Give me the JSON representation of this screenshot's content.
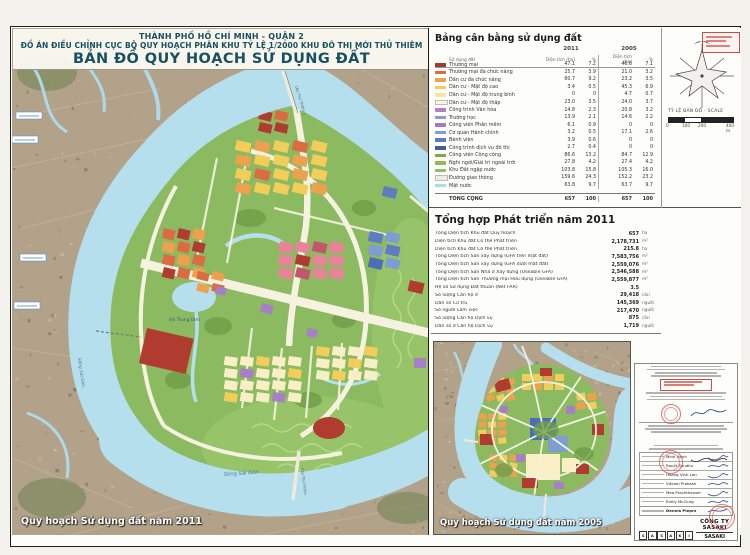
{
  "title": {
    "line1": "THÀNH PHỐ HỒ CHÍ MINH - QUẬN 2",
    "line2": "ĐỒ ÁN ĐIỀU CHỈNH CỤC BỘ QUY HOẠCH PHÂN KHU TỶ LỆ 1/2000 KHU ĐÔ THỊ MỚI THỦ THIÊM",
    "line3": "BẢN ĐỒ QUY HOẠCH SỬ DỤNG ĐẤT"
  },
  "balance_table": {
    "title": "Bảng cân bằng sử dụng đất",
    "year1": "2011",
    "year2": "2005",
    "col_land_use": "Sử dụng đất",
    "col_area": "Diện tích (ha)",
    "col_pct": "%",
    "rows": [
      {
        "name": "Thương mại",
        "color": "#a03a30",
        "a1": "47.1",
        "p1": "7.2",
        "a2": "46.6",
        "p2": "7.1"
      },
      {
        "name": "Thương mại đa chức năng",
        "color": "#dd6b42",
        "a1": "25.7",
        "p1": "3.9",
        "a2": "21.0",
        "p2": "3.2"
      },
      {
        "name": "Dân cư đa chức năng",
        "color": "#eda14f",
        "a1": "60.7",
        "p1": "9.2",
        "a2": "23.2",
        "p2": "3.5"
      },
      {
        "name": "Dân cư - Mật độ cao",
        "color": "#f2cd5a",
        "a1": "3.4",
        "p1": "0.5",
        "a2": "45.3",
        "p2": "6.9"
      },
      {
        "name": "Dân cư - Mật độ trung bình",
        "color": "#f6e59c",
        "a1": "0",
        "p1": "0",
        "a2": "4.7",
        "p2": "0.7"
      },
      {
        "name": "Dân cư - Mật độ thấp",
        "color": "#fcf6d8",
        "a1": "23.0",
        "p1": "3.5",
        "a2": "24.0",
        "p2": "3.7"
      },
      {
        "name": "Công trình Văn hóa",
        "color": "#b27fc6",
        "a1": "14.8",
        "p1": "2.3",
        "a2": "20.8",
        "p2": "3.2"
      },
      {
        "name": "Trường học",
        "color": "#9099cf",
        "a1": "13.9",
        "p1": "2.1",
        "a2": "14.6",
        "p2": "2.2"
      },
      {
        "name": "Công viên Phần mềm",
        "color": "#9f7cc5",
        "a1": "6.1",
        "p1": "0.9",
        "a2": "0",
        "p2": "0"
      },
      {
        "name": "Cơ quan Hành chính",
        "color": "#7e9ed2",
        "a1": "3.2",
        "p1": "0.5",
        "a2": "17.1",
        "p2": "2.6"
      },
      {
        "name": "Bệnh viện",
        "color": "#5d7dc0",
        "a1": "3.9",
        "p1": "0.6",
        "a2": "0",
        "p2": "0"
      },
      {
        "name": "Công trình dịch vụ đô thị",
        "color": "#3f5f9d",
        "a1": "2.7",
        "p1": "0.4",
        "a2": "0",
        "p2": "0"
      },
      {
        "name": "Công viên Công cộng",
        "color": "#77a94d",
        "a1": "86.6",
        "p1": "13.2",
        "a2": "84.7",
        "p2": "12.9"
      },
      {
        "name": "Nghỉ ngơi/Giải trí ngoài trời",
        "color": "#9fb35c",
        "a1": "27.8",
        "p1": "4.2",
        "a2": "27.4",
        "p2": "4.2"
      },
      {
        "name": "Khu Đất ngập nước",
        "color": "#8ec16d",
        "a1": "103.8",
        "p1": "15.8",
        "a2": "105.3",
        "p2": "16.0"
      },
      {
        "name": "Đường giao thông",
        "color": "#f0ecdc",
        "a1": "159.6",
        "p1": "24.3",
        "a2": "152.2",
        "p2": "23.2"
      },
      {
        "name": "Mặt nước",
        "color": "#aadcea",
        "a1": "63.8",
        "p1": "9.7",
        "a2": "63.7",
        "p2": "9.7"
      }
    ],
    "total_label": "TỔNG CỘNG",
    "total": {
      "a1": "657",
      "p1": "100",
      "a2": "657",
      "p2": "100"
    }
  },
  "development": {
    "title": "Tổng hợp Phát triển năm 2011",
    "rows": [
      {
        "label": "Tổng Diện tích Khu đất Quy hoạch",
        "value": "657",
        "unit": "ha"
      },
      {
        "label": "Diện tích Khu đất Có thể Phát triển",
        "value": "2,178,731",
        "unit": "m²"
      },
      {
        "label": "Diện tích Khu đất Có thể Phát triển",
        "value": "215.8",
        "unit": "ha"
      },
      {
        "label": "Tổng Diện tích Sàn xây dựng (GFA trên mặt đất)",
        "value": "7,583,756",
        "unit": "m²"
      },
      {
        "label": "Tổng Diện tích Sàn xây dựng (GFA dưới mặt đất)",
        "value": "2,559,076",
        "unit": "m²"
      },
      {
        "label": "Tổng Diện tích Sàn Nhà ở Xây dựng (Useable GFA)",
        "value": "2,546,588",
        "unit": "m²"
      },
      {
        "label": "Tổng Diện tích Sàn Thương mại Hữu dụng (Useable GFA)",
        "value": "2,559,877",
        "unit": "m²"
      },
      {
        "label": "Hệ số Sử dụng Đất thuần (Net FAR)",
        "value": "3.5",
        "unit": ""
      },
      {
        "label": "Số lượng Căn hộ ở",
        "value": "29,418",
        "unit": "căn"
      },
      {
        "label": "Dân số Cư trú",
        "value": "145,369",
        "unit": "người"
      },
      {
        "label": "Số người Làm việc",
        "value": "217,470",
        "unit": "người"
      },
      {
        "label": "Số lượng Căn hộ Dịch vụ",
        "value": "875",
        "unit": "căn"
      },
      {
        "label": "Dân số ở Căn hộ Dịch vụ",
        "value": "1,719",
        "unit": "người"
      }
    ]
  },
  "compass": {
    "scale_label": "TỶ LỆ BẢN ĐỒ - SCALE",
    "scale_ticks": [
      "0",
      "100",
      "200",
      "400 m"
    ]
  },
  "map_2011": {
    "label": "Quy hoạch Sử dụng đất năm 2011",
    "lake_label": "Hồ Trung tâm",
    "river_label": "Sông Sài Gòn",
    "river_label2": "Sông Sài Gòn",
    "bridge1_label": "Cầu Thủ Thiêm 1",
    "bridge2_label": "Cầu Thủ Thiêm"
  },
  "map_2005": {
    "label": "Quy hoạch Sử dụng đất  năm 2005"
  },
  "signature_block": {
    "names": [
      "Minh Hanh",
      "Ranjit Sandhu",
      "Hoang Vinh Lan",
      "Vikram Prakash",
      "Mea Prachthauser",
      "Emily McClurg"
    ],
    "principal": "Dennis Pieprz",
    "company_line1": "CÔNG TY SASAKI",
    "company_line2": "SASAKI ASSOCIATES INC.",
    "letters": [
      "S",
      "A",
      "S",
      "A",
      "K",
      "I"
    ]
  },
  "colors": {
    "water": "#b6dfee",
    "park_green": "#8cba60",
    "aerial": "#b1a289",
    "road": "#f6f2e0",
    "title_teal": "#17505f",
    "stamp_red": "#d4564c"
  }
}
